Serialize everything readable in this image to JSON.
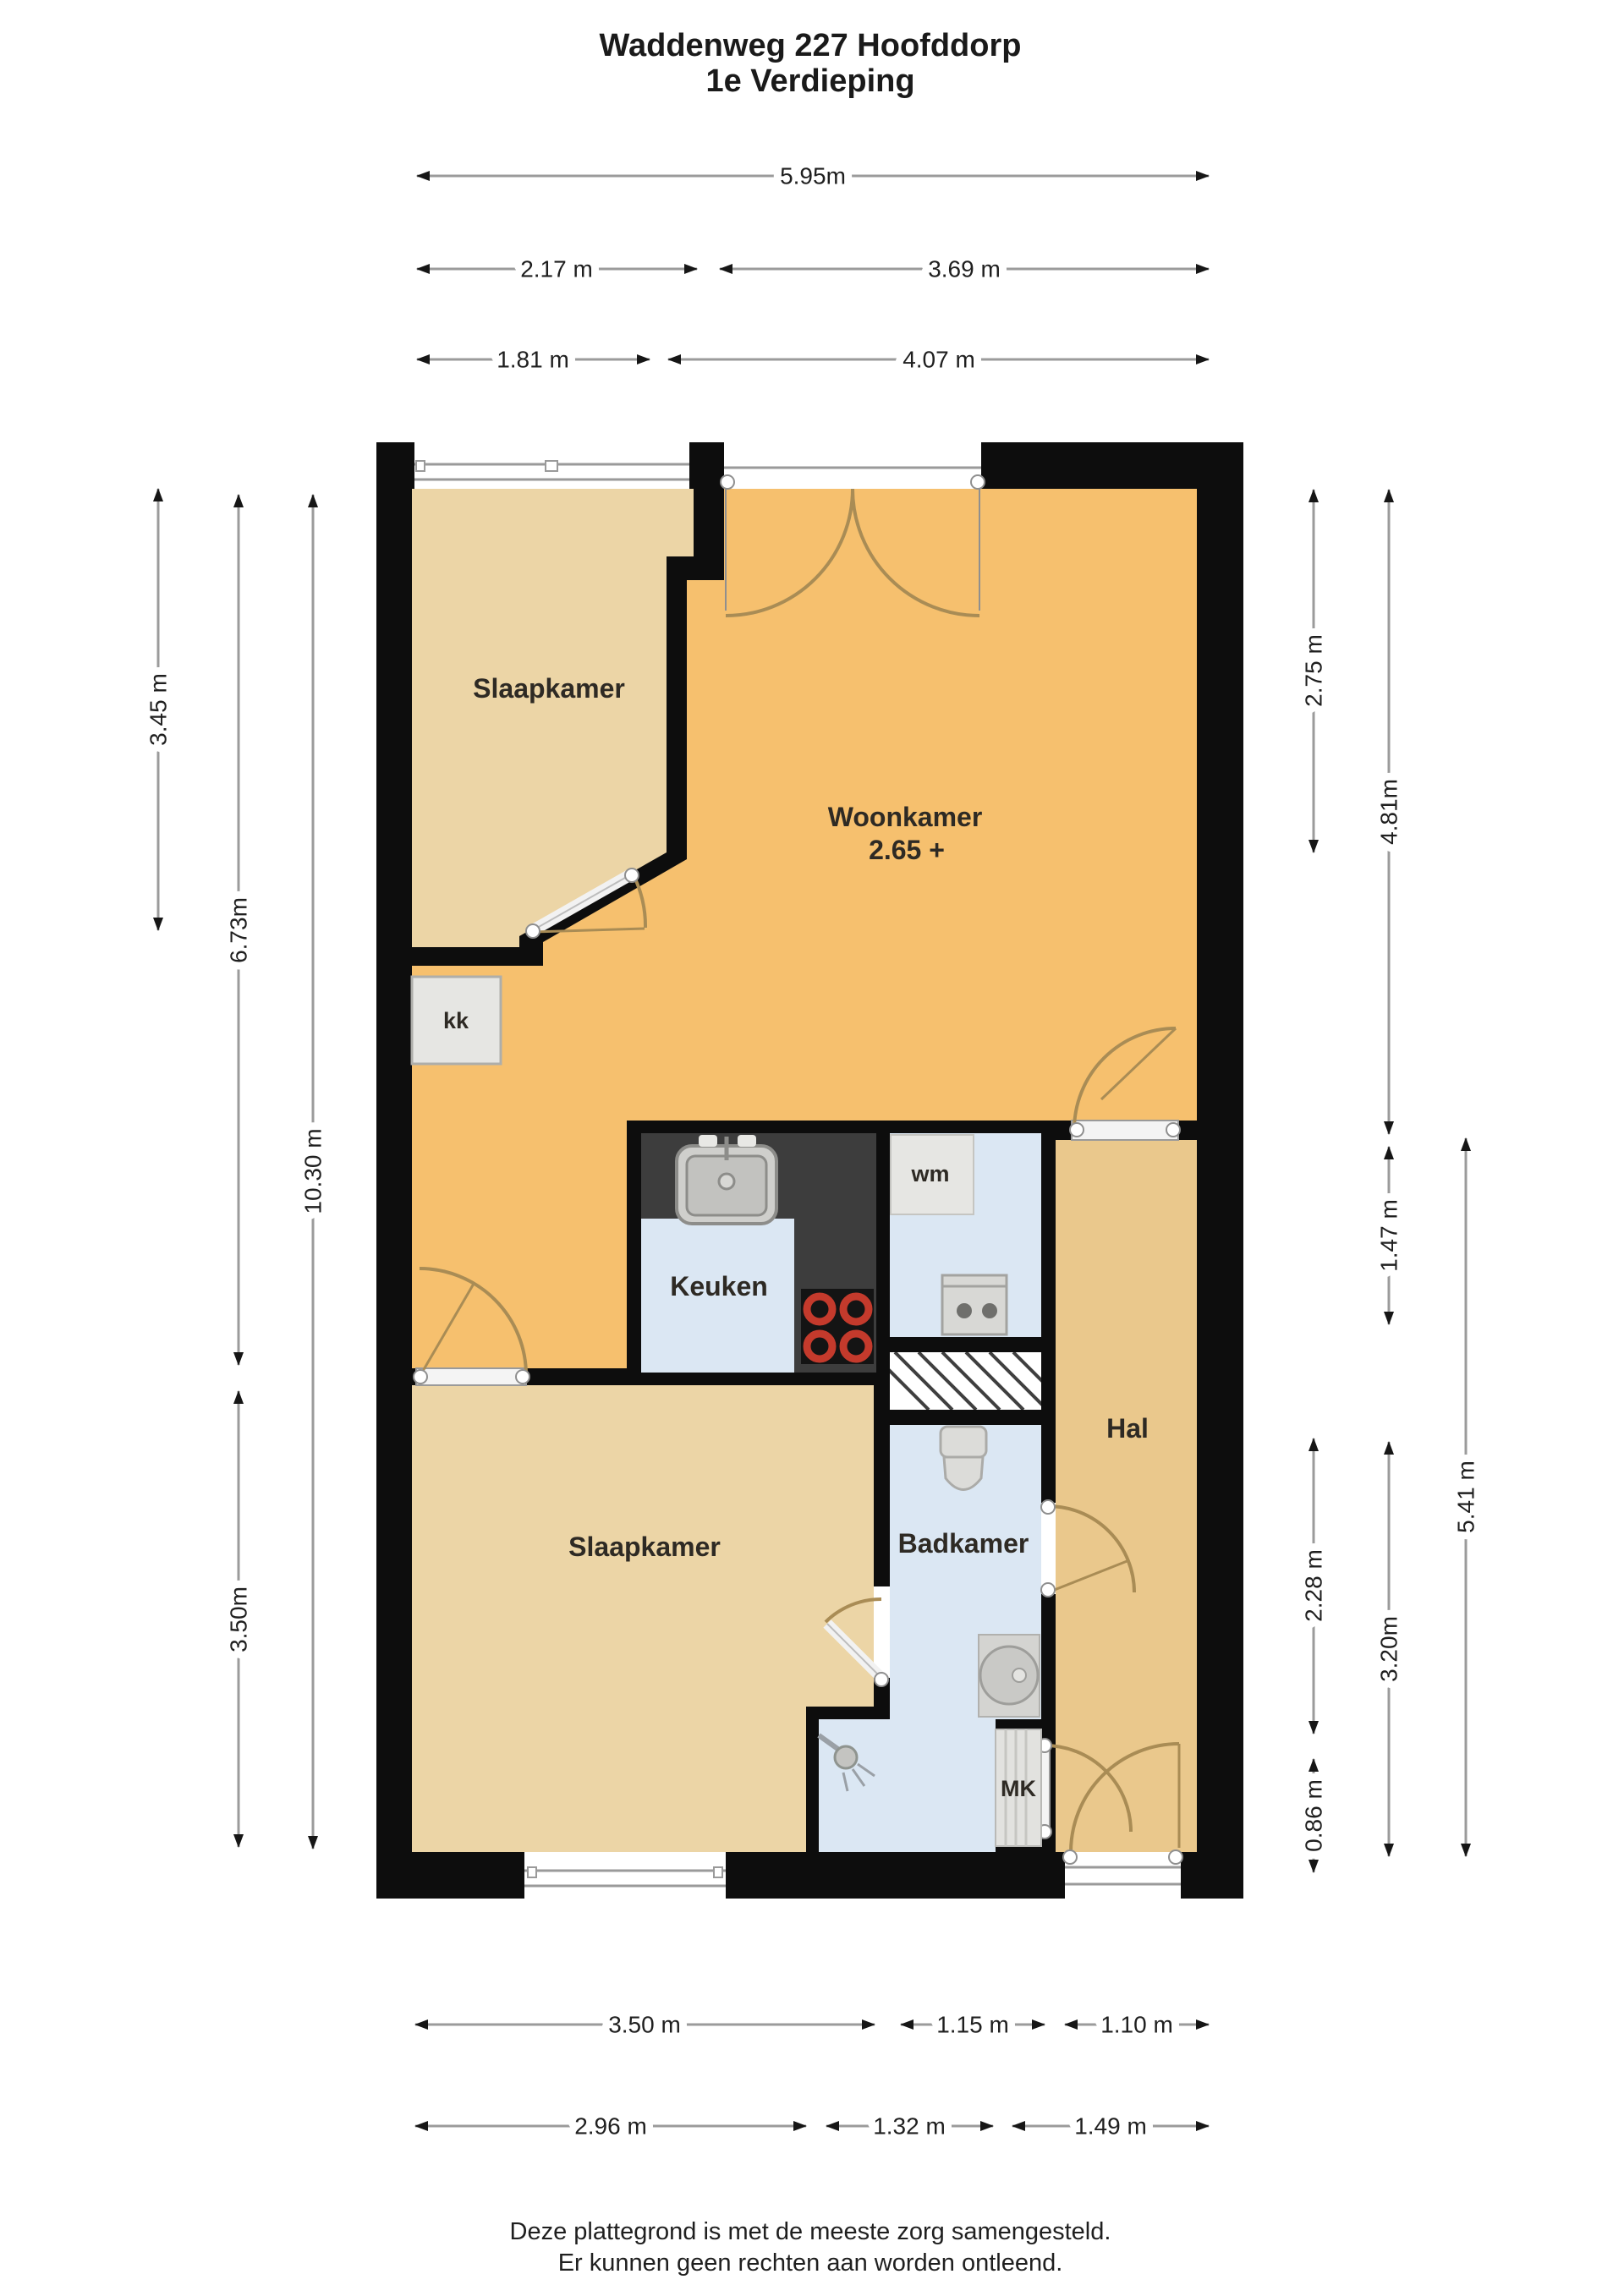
{
  "title": {
    "line1": "Waddenweg 227 Hoofddorp",
    "line2": "1e Verdieping"
  },
  "floorplan": {
    "rooms": {
      "bedroom_top": "Slaapkamer",
      "living": "Woonkamer",
      "living_height_note": "2.65 +",
      "kitchen_closet": "kk",
      "kitchen": "Keuken",
      "washer_closet": "wm",
      "hall": "Hal",
      "bathroom": "Badkamer",
      "bedroom_bottom": "Slaapkamer",
      "meter_closet": "MK"
    },
    "colors": {
      "wall": "#0d0d0d",
      "living_floor": "#f6c06e",
      "bedroom_floor": "#ecd5a6",
      "hall_floor": "#eac88c",
      "wet_room_floor": "#dbe7f3",
      "counter": "#3d3d3d",
      "burner_red": "#c43a2c",
      "door_arc": "#a98c55",
      "dimension_line": "#9b9b9b"
    },
    "icons": [
      "sink-icon",
      "stove-icon",
      "washing-machine-icon",
      "toilet-icon",
      "washbasin-icon",
      "shower-icon",
      "stairs-hatch-icon"
    ]
  },
  "dimensions": {
    "top": [
      {
        "label": "5.95m",
        "value_m": 5.95
      },
      {
        "label": "2.17 m",
        "value_m": 2.17
      },
      {
        "label": "3.69 m",
        "value_m": 3.69
      },
      {
        "label": "1.81 m",
        "value_m": 1.81
      },
      {
        "label": "4.07 m",
        "value_m": 4.07
      }
    ],
    "left": [
      {
        "label": "3.45 m",
        "value_m": 3.45
      },
      {
        "label": "6.73m",
        "value_m": 6.73
      },
      {
        "label": "10.30 m",
        "value_m": 10.3
      },
      {
        "label": "3.50m",
        "value_m": 3.5
      }
    ],
    "right": [
      {
        "label": "2.75 m",
        "value_m": 2.75
      },
      {
        "label": "4.81m",
        "value_m": 4.81
      },
      {
        "label": "1.47 m",
        "value_m": 1.47
      },
      {
        "label": "2.28 m",
        "value_m": 2.28
      },
      {
        "label": "0.86 m",
        "value_m": 0.86
      },
      {
        "label": "3.20m",
        "value_m": 3.2
      },
      {
        "label": "5.41 m",
        "value_m": 5.41
      }
    ],
    "bottom": [
      {
        "label": "3.50 m",
        "value_m": 3.5
      },
      {
        "label": "1.15 m",
        "value_m": 1.15
      },
      {
        "label": "1.10 m",
        "value_m": 1.1
      },
      {
        "label": "2.96 m",
        "value_m": 2.96
      },
      {
        "label": "1.32 m",
        "value_m": 1.32
      },
      {
        "label": "1.49 m",
        "value_m": 1.49
      }
    ]
  },
  "footer": {
    "line1": "Deze plattegrond is met de meeste zorg samengesteld.",
    "line2": "Er kunnen geen rechten aan worden ontleend."
  }
}
